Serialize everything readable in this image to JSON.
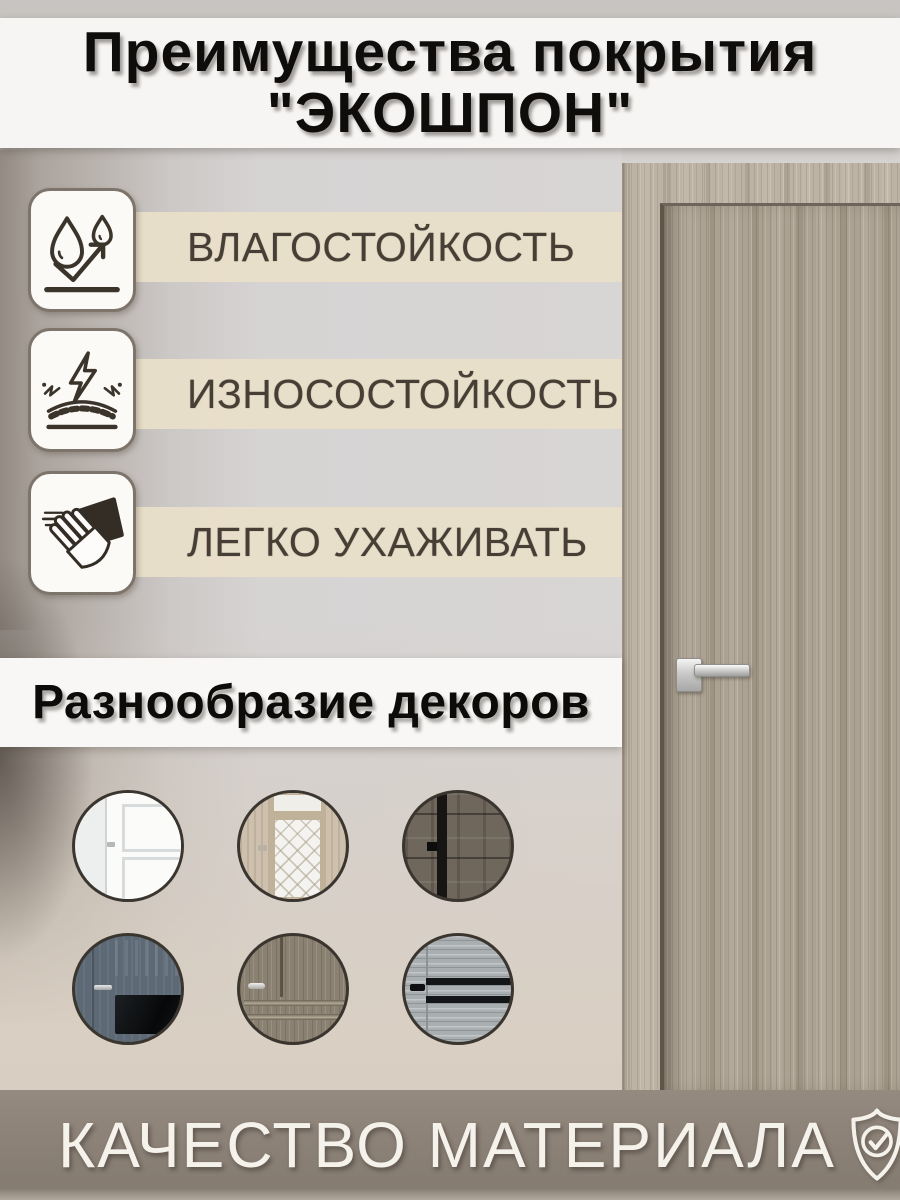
{
  "title": {
    "line1": "Преимущества покрытия",
    "line2": "\"ЭКОШПОН\""
  },
  "features": {
    "items": [
      {
        "label": "ВЛАГОСТОЙКОСТЬ",
        "icon": "water-drops-icon"
      },
      {
        "label": "ИЗНОСОСТОЙКОСТЬ",
        "icon": "impact-resistance-icon"
      },
      {
        "label": "ЛЕГКО УХАЖИВАТЬ",
        "icon": "wipe-clean-icon"
      }
    ]
  },
  "decors": {
    "title": "Разнообразие декоров",
    "items": [
      {
        "name": "white-classic-door"
      },
      {
        "name": "glass-insert-door"
      },
      {
        "name": "dark-rustic-wood-door"
      },
      {
        "name": "blue-gray-dark-glass-door"
      },
      {
        "name": "classic-wood-panel-door"
      },
      {
        "name": "gray-wood-black-stripe-door"
      }
    ]
  },
  "footer": {
    "label": "КАЧЕСТВО МАТЕРИАЛА",
    "icon": "shield-check-icon"
  },
  "colors": {
    "band_cream": "#e9dfc9",
    "banner_white": "#f7f5f3",
    "footer_band": "#8a8076",
    "text_dark": "#473f35",
    "door_wood": "#aca293",
    "wall_gray": "#d6d3d3"
  }
}
